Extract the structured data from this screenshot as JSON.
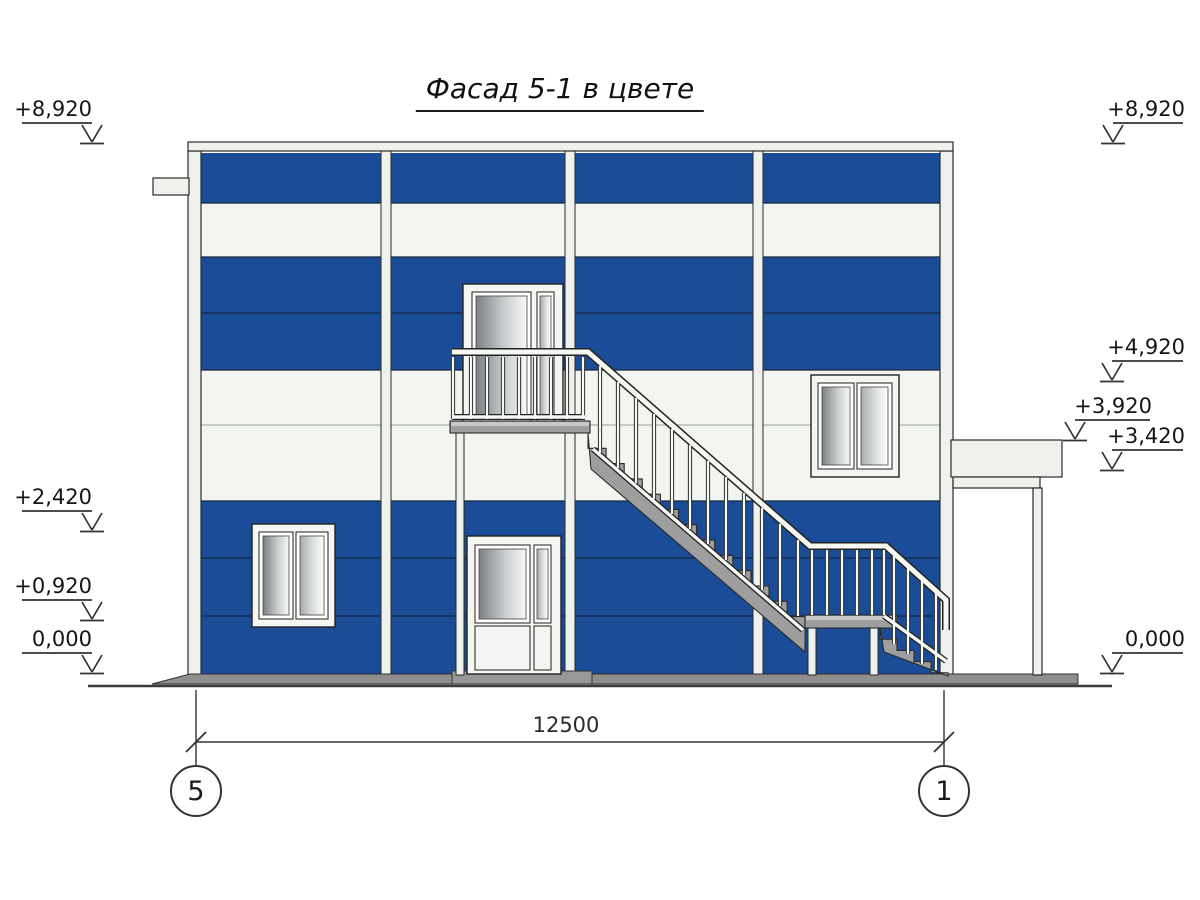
{
  "title": "Фасад 5-1 в цвете",
  "drawing": {
    "type": "facade-elevation",
    "colors": {
      "facade_blue": "#1b4c98",
      "panel_white": "#f2f5f0",
      "trim_white": "#eef1ec",
      "stair_gray": "#9e9e9e",
      "ground_gray": "#8f8f8f"
    }
  },
  "elevation_markers": {
    "left": [
      {
        "label": "+8,920"
      },
      {
        "label": "+2,420"
      },
      {
        "label": "+0,920"
      },
      {
        "label": "0,000"
      }
    ],
    "right": [
      {
        "label": "+8,920"
      },
      {
        "label": "+4,920"
      },
      {
        "label": "+3,920"
      },
      {
        "label": "+3,420"
      },
      {
        "label": "0,000"
      }
    ]
  },
  "dimension": {
    "value": "12500"
  },
  "axes": [
    {
      "label": "5"
    },
    {
      "label": "1"
    }
  ]
}
